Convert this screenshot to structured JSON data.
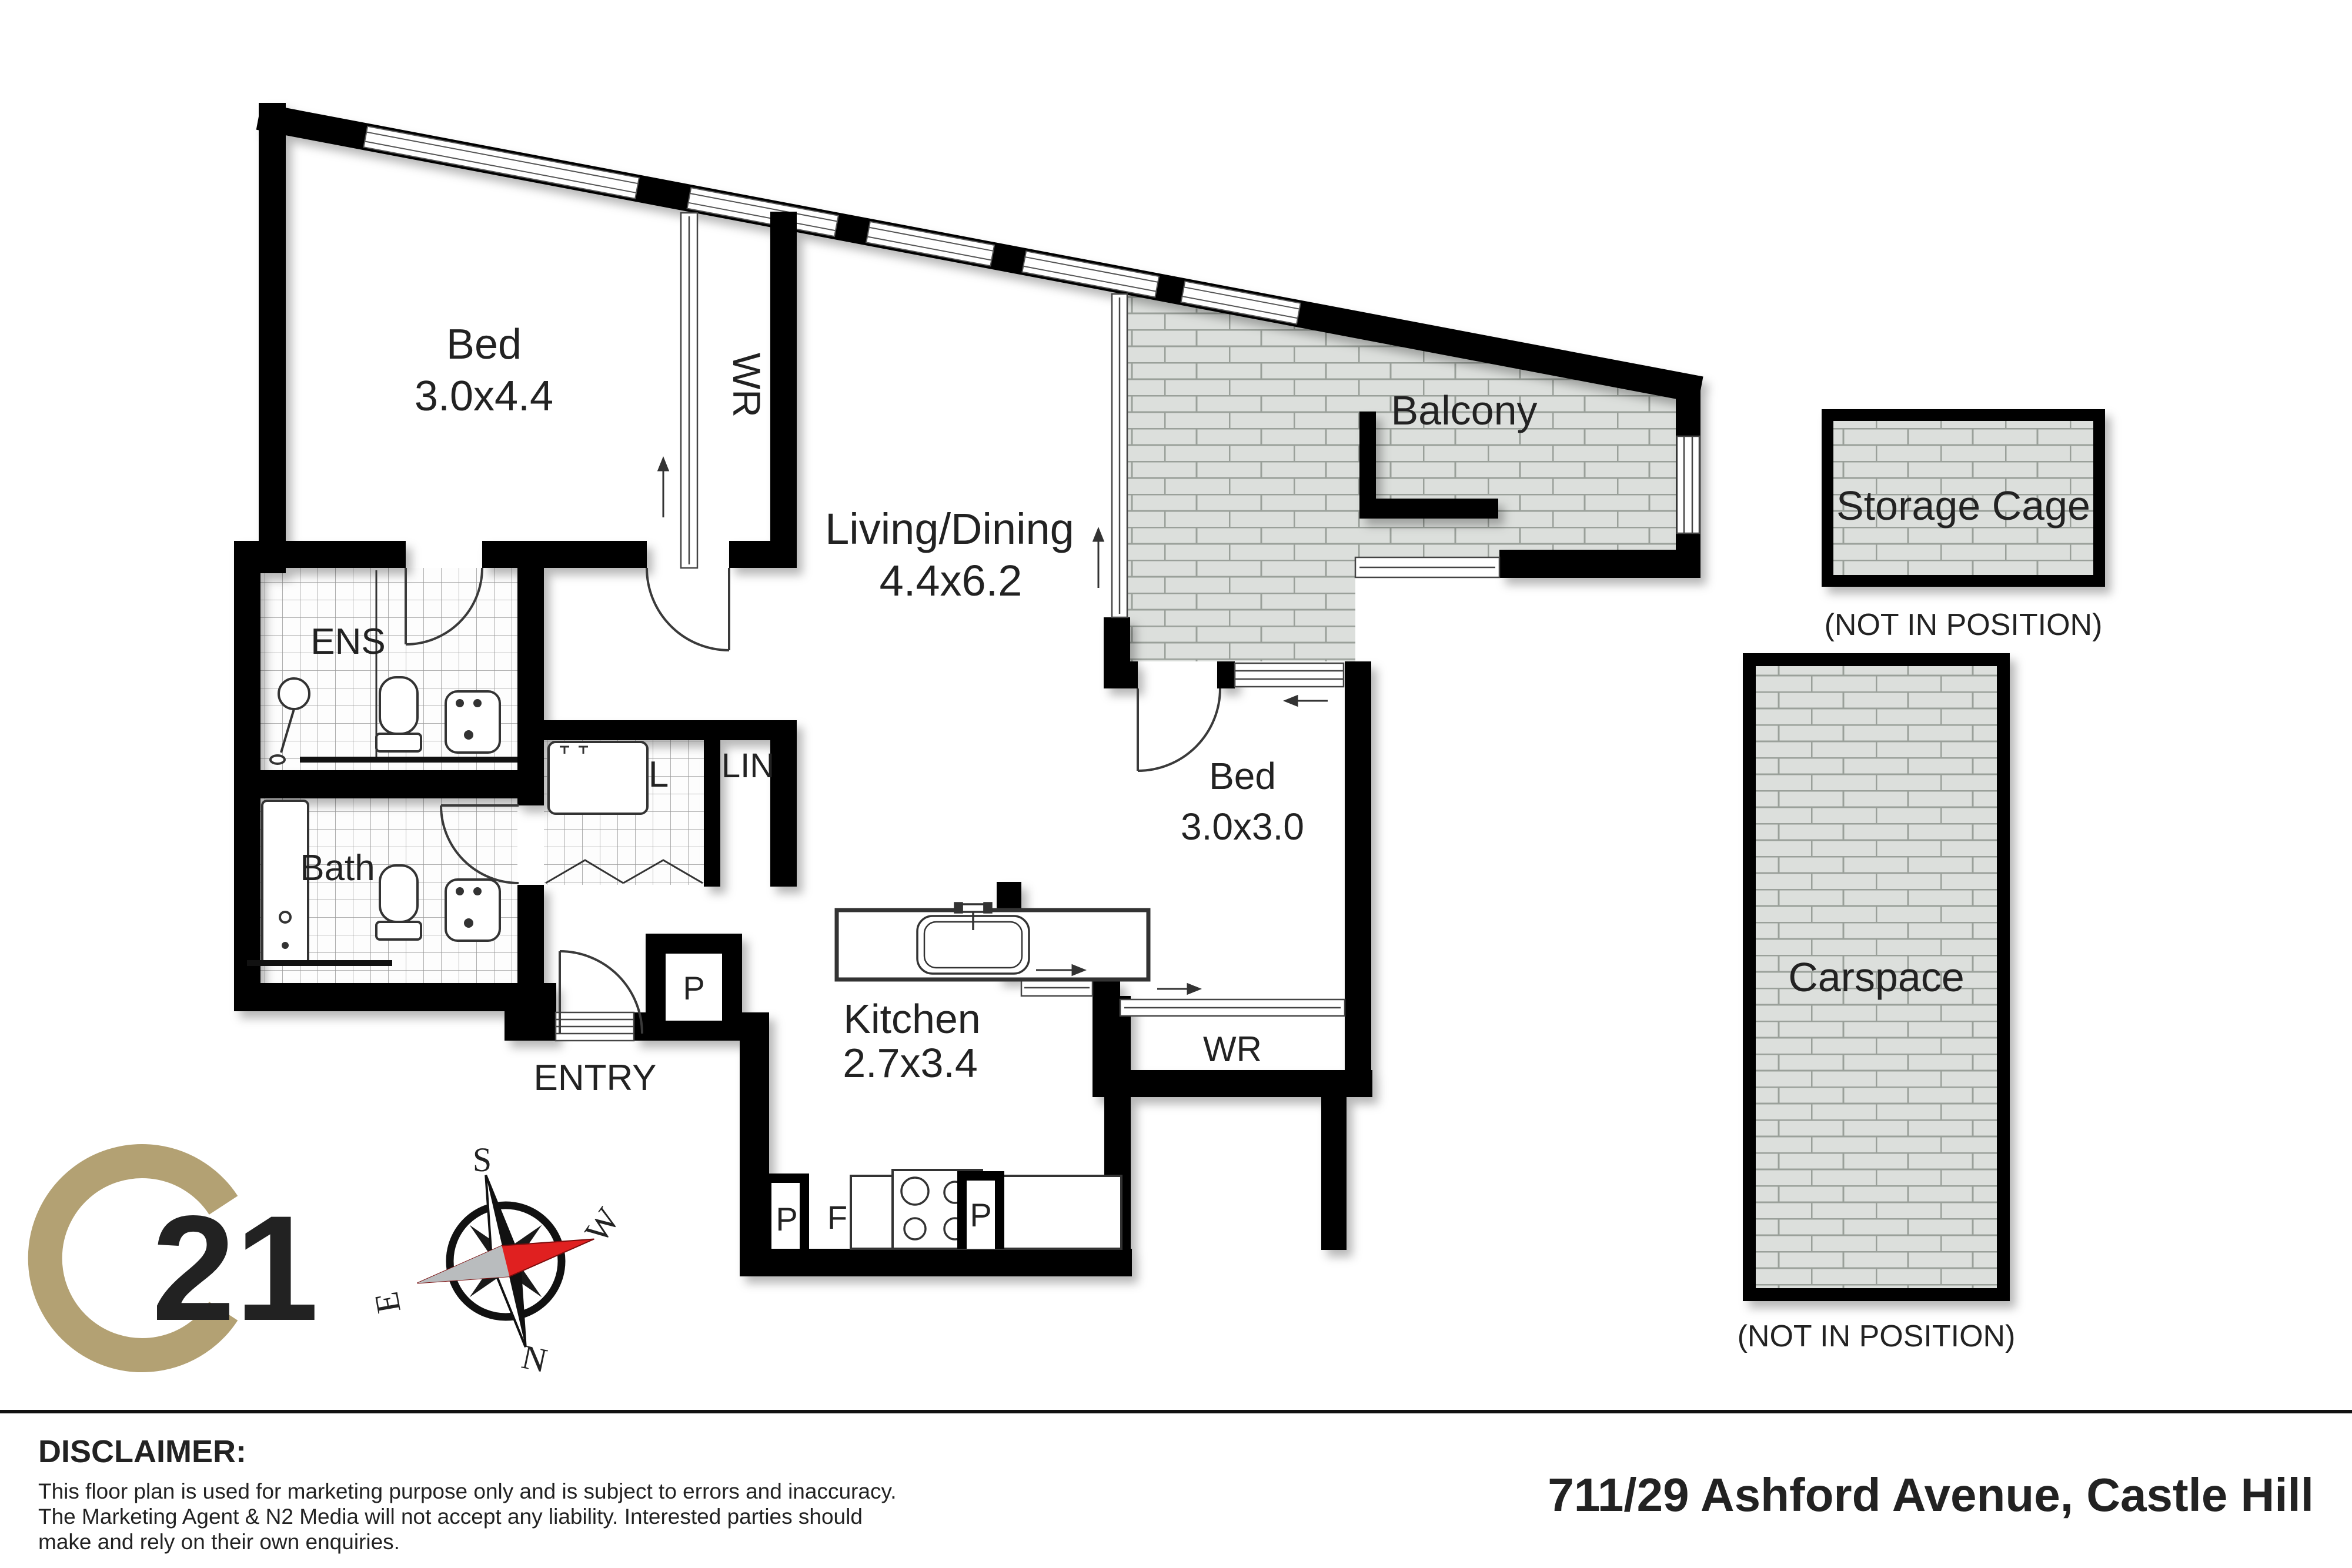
{
  "floorplan": {
    "rooms": {
      "bed1": {
        "label": "Bed",
        "dims": "3.0x4.4"
      },
      "wr1": {
        "label": "WR"
      },
      "living": {
        "label": "Living/Dining",
        "dims": "4.4x6.2"
      },
      "balcony": {
        "label": "Balcony"
      },
      "ens": {
        "label": "ENS"
      },
      "laundry": {
        "label": "L"
      },
      "linen": {
        "label": "LIN"
      },
      "bath": {
        "label": "Bath"
      },
      "bed2": {
        "label": "Bed",
        "dims": "3.0x3.0"
      },
      "wr2": {
        "label": "WR"
      },
      "kitchen": {
        "label": "Kitchen",
        "dims": "2.7x3.4"
      },
      "entry": {
        "label": "ENTRY"
      }
    },
    "markers": {
      "pantry_entry": "P",
      "pantry_left": "P",
      "fridge": "F",
      "pantry_right": "P"
    }
  },
  "outside": {
    "storage": {
      "label": "Storage Cage",
      "note": "(NOT IN POSITION)"
    },
    "carspace": {
      "label": "Carspace",
      "note": "(NOT IN POSITION)"
    }
  },
  "compass": {
    "north": "N",
    "south": "S",
    "east": "E",
    "west": "W"
  },
  "logo": {
    "number": "21"
  },
  "footer": {
    "disclaimer_title": "DISCLAIMER:",
    "disclaimer_lines": [
      "This floor plan is used for marketing purpose only and is subject to errors and inaccuracy.",
      "The Marketing Agent & N2 Media will not accept any liability. Interested parties should",
      "make and rely on their own enquiries."
    ],
    "address": "711/29 Ashford Avenue, Castle Hill"
  },
  "colors": {
    "wall": "#000000",
    "brick_fill": "#dcdfdc",
    "brick_line": "#9aa09a",
    "tile_line": "#999999",
    "gold": "#b3a173",
    "compass_red": "#e02020",
    "text": "#222222"
  }
}
